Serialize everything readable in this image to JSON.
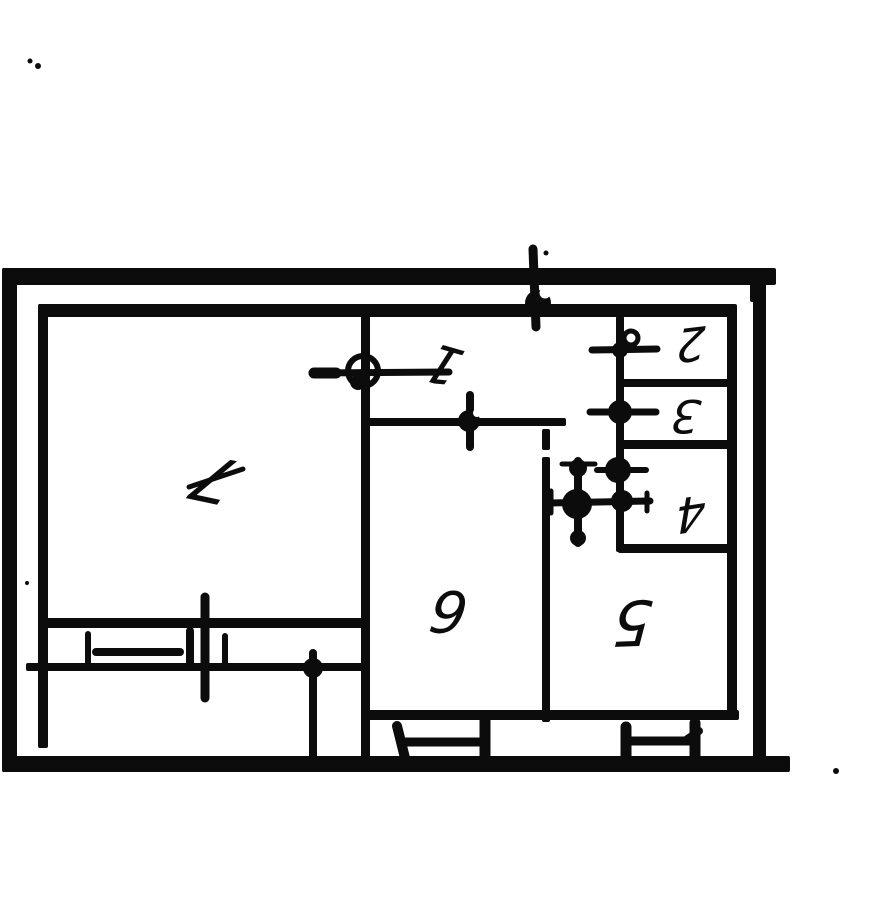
{
  "plan": {
    "rooms": [
      {
        "number": "1"
      },
      {
        "number": "2"
      },
      {
        "number": "3"
      },
      {
        "number": "4"
      },
      {
        "number": "5"
      },
      {
        "number": "6"
      },
      {
        "number": "7"
      }
    ],
    "colors": {
      "ink": "#0c0c0c",
      "paper": "#ffffff"
    },
    "icons": [
      "entry-riser-valve-icon",
      "door-ring-valve-icon",
      "valve-cross-icon",
      "radiator-cross-icon",
      "window-icon",
      "balcony-door-icon",
      "riser-line-icon"
    ]
  }
}
